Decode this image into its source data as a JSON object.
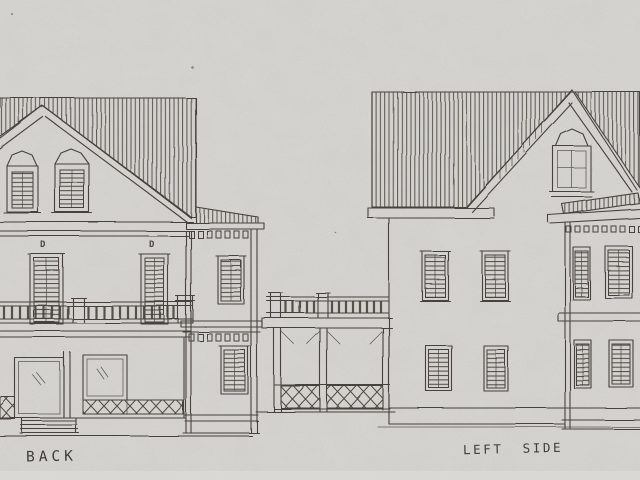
{
  "labels": {
    "back": "BACK",
    "left_side": "LEFT SIDE"
  },
  "annotations": {
    "door_marks": [
      "D",
      "D"
    ]
  },
  "colors": {
    "paper": "#d7d5d1",
    "ink": "#46423c"
  }
}
